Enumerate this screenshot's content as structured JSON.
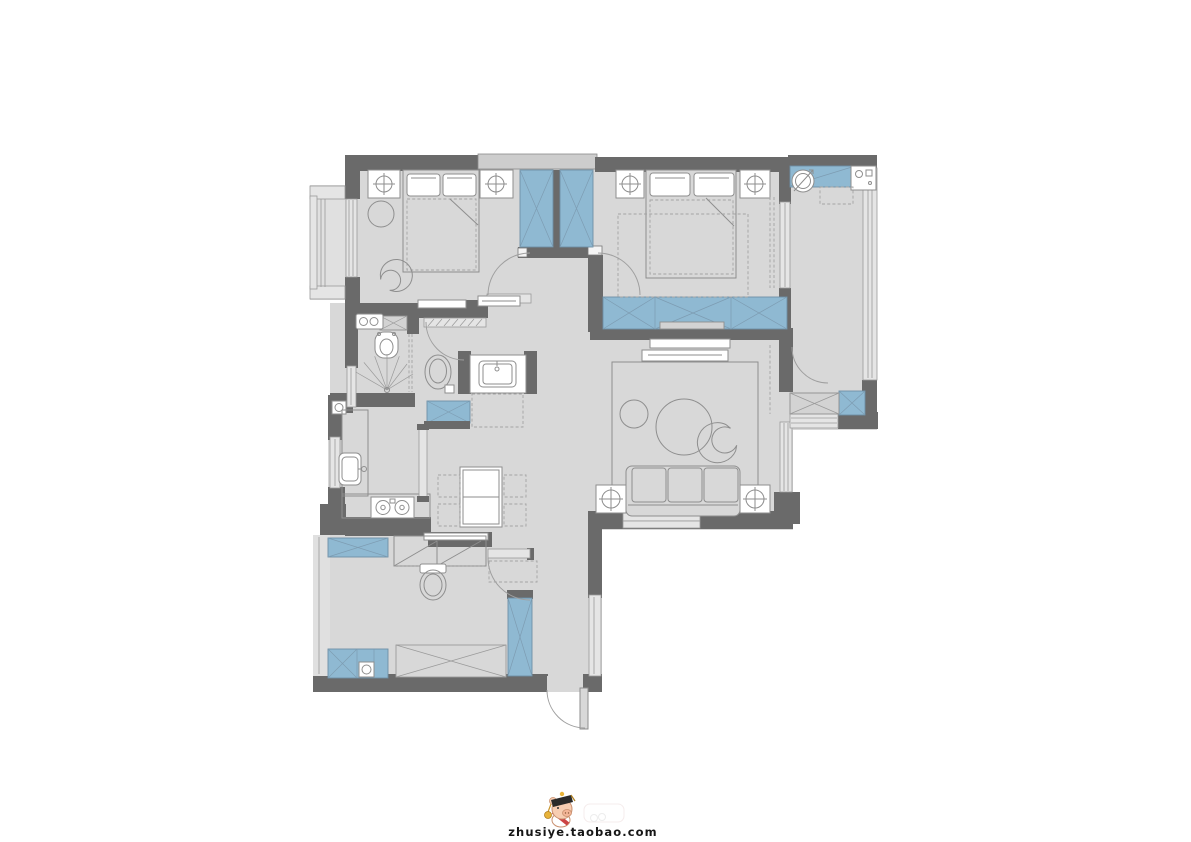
{
  "canvas": {
    "width": 1191,
    "height": 842,
    "background": "#ffffff"
  },
  "watermark": {
    "text": "zhusiye.taobao.com",
    "logo": "pig-mascot-icon"
  },
  "palette": {
    "wall": "#6a6a6a",
    "floor": "#d8d8d8",
    "floor_light": "#e0e0e0",
    "blue": "#8fb9d2",
    "line": "#8e8e8e",
    "win": "#e5e5e5",
    "wm": "#161616"
  },
  "plan": {
    "type": "residential-apartment-floor-plan",
    "view": "top-down 2D furnished plan, no text labels on rooms",
    "rooms": [
      "bedroom top-left: double bed, two nightstands with lamps, round rug, tub chair, low benches, bay window on left",
      "wardrobe block between bedrooms: two blue built-in closets with swing doors below",
      "master bedroom top-right: double bed, nightstands with lamps, rug, curtain wall to balcony, blue built-in wardrobe strip on south wall",
      "laundry balcony right: blue counter with round basin, washing machine, storage cabinets at bottom, full-height window",
      "living room: TV console on wardrobe wall, area rug, two round coffee tables, tub chair, three-seat sofa with two lamp side tables, window in south wall",
      "bathroom: twin-faucet basin, smart toilet, shower with spray fan and glass partition, toilet, sliding hatched door, external vanity with sink and mat",
      "kitchen: L-shaped counter, sink, 2-burner hob, water heater, sliding door, window on left",
      "dining area: rectangular table with four dashed chairs, blue sideboard cabinet",
      "utility room bottom: desk/bench with diagonal panels, wall-hung toilet, blue storage cabinets, floor drain, wide X cabinet, tall blue cabinet",
      "entry bottom: outward-swinging front door"
    ],
    "legend": {
      "dark_grey": "structural walls",
      "light_grey": "floor area",
      "blue_fill": "built-in cabinets / wardrobes / counters",
      "x_cross": "cabinet / storage symbol",
      "dashed": "rugs, chairs, optional furniture",
      "quarter_arcs": "door swings",
      "triple_lines": "windows / glazing"
    }
  }
}
